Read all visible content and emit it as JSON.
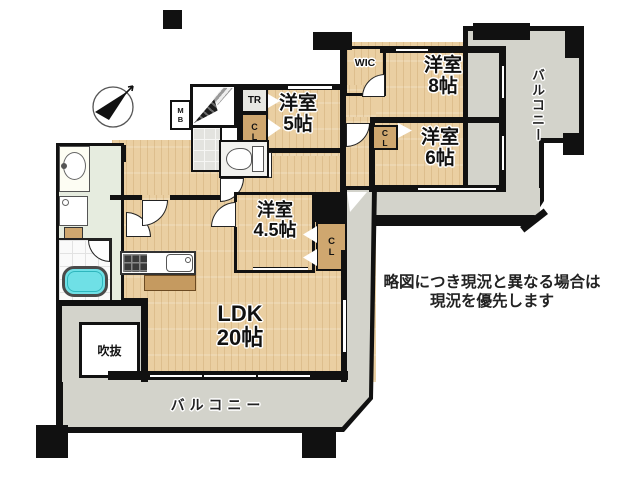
{
  "rooms": {
    "r8": {
      "name": "洋室",
      "size": "8帖"
    },
    "r5": {
      "name": "洋室",
      "size": "5帖"
    },
    "r6": {
      "name": "洋室",
      "size": "6帖"
    },
    "r45": {
      "name": "洋室",
      "size": "4.5帖"
    },
    "ldk": {
      "name": "LDK",
      "size": "20帖"
    },
    "void_label": "吹抜"
  },
  "storage": {
    "wic": "WIC",
    "tr": "TR",
    "cl": "CL",
    "mb": "MB",
    "ps": "PS"
  },
  "balcony_label": "バルコニー",
  "disclaimer": {
    "line1": "略図につき現況と異なる場合は",
    "line2": "現況を優先します"
  },
  "colors": {
    "wood": "#eacfa2",
    "balcony_gray": "#d3d3cb",
    "wall": "#111111",
    "bathtub": "#6fe0e6",
    "washroom_floor": "#e6ecdf",
    "closet_tan": "#cfa76f"
  }
}
